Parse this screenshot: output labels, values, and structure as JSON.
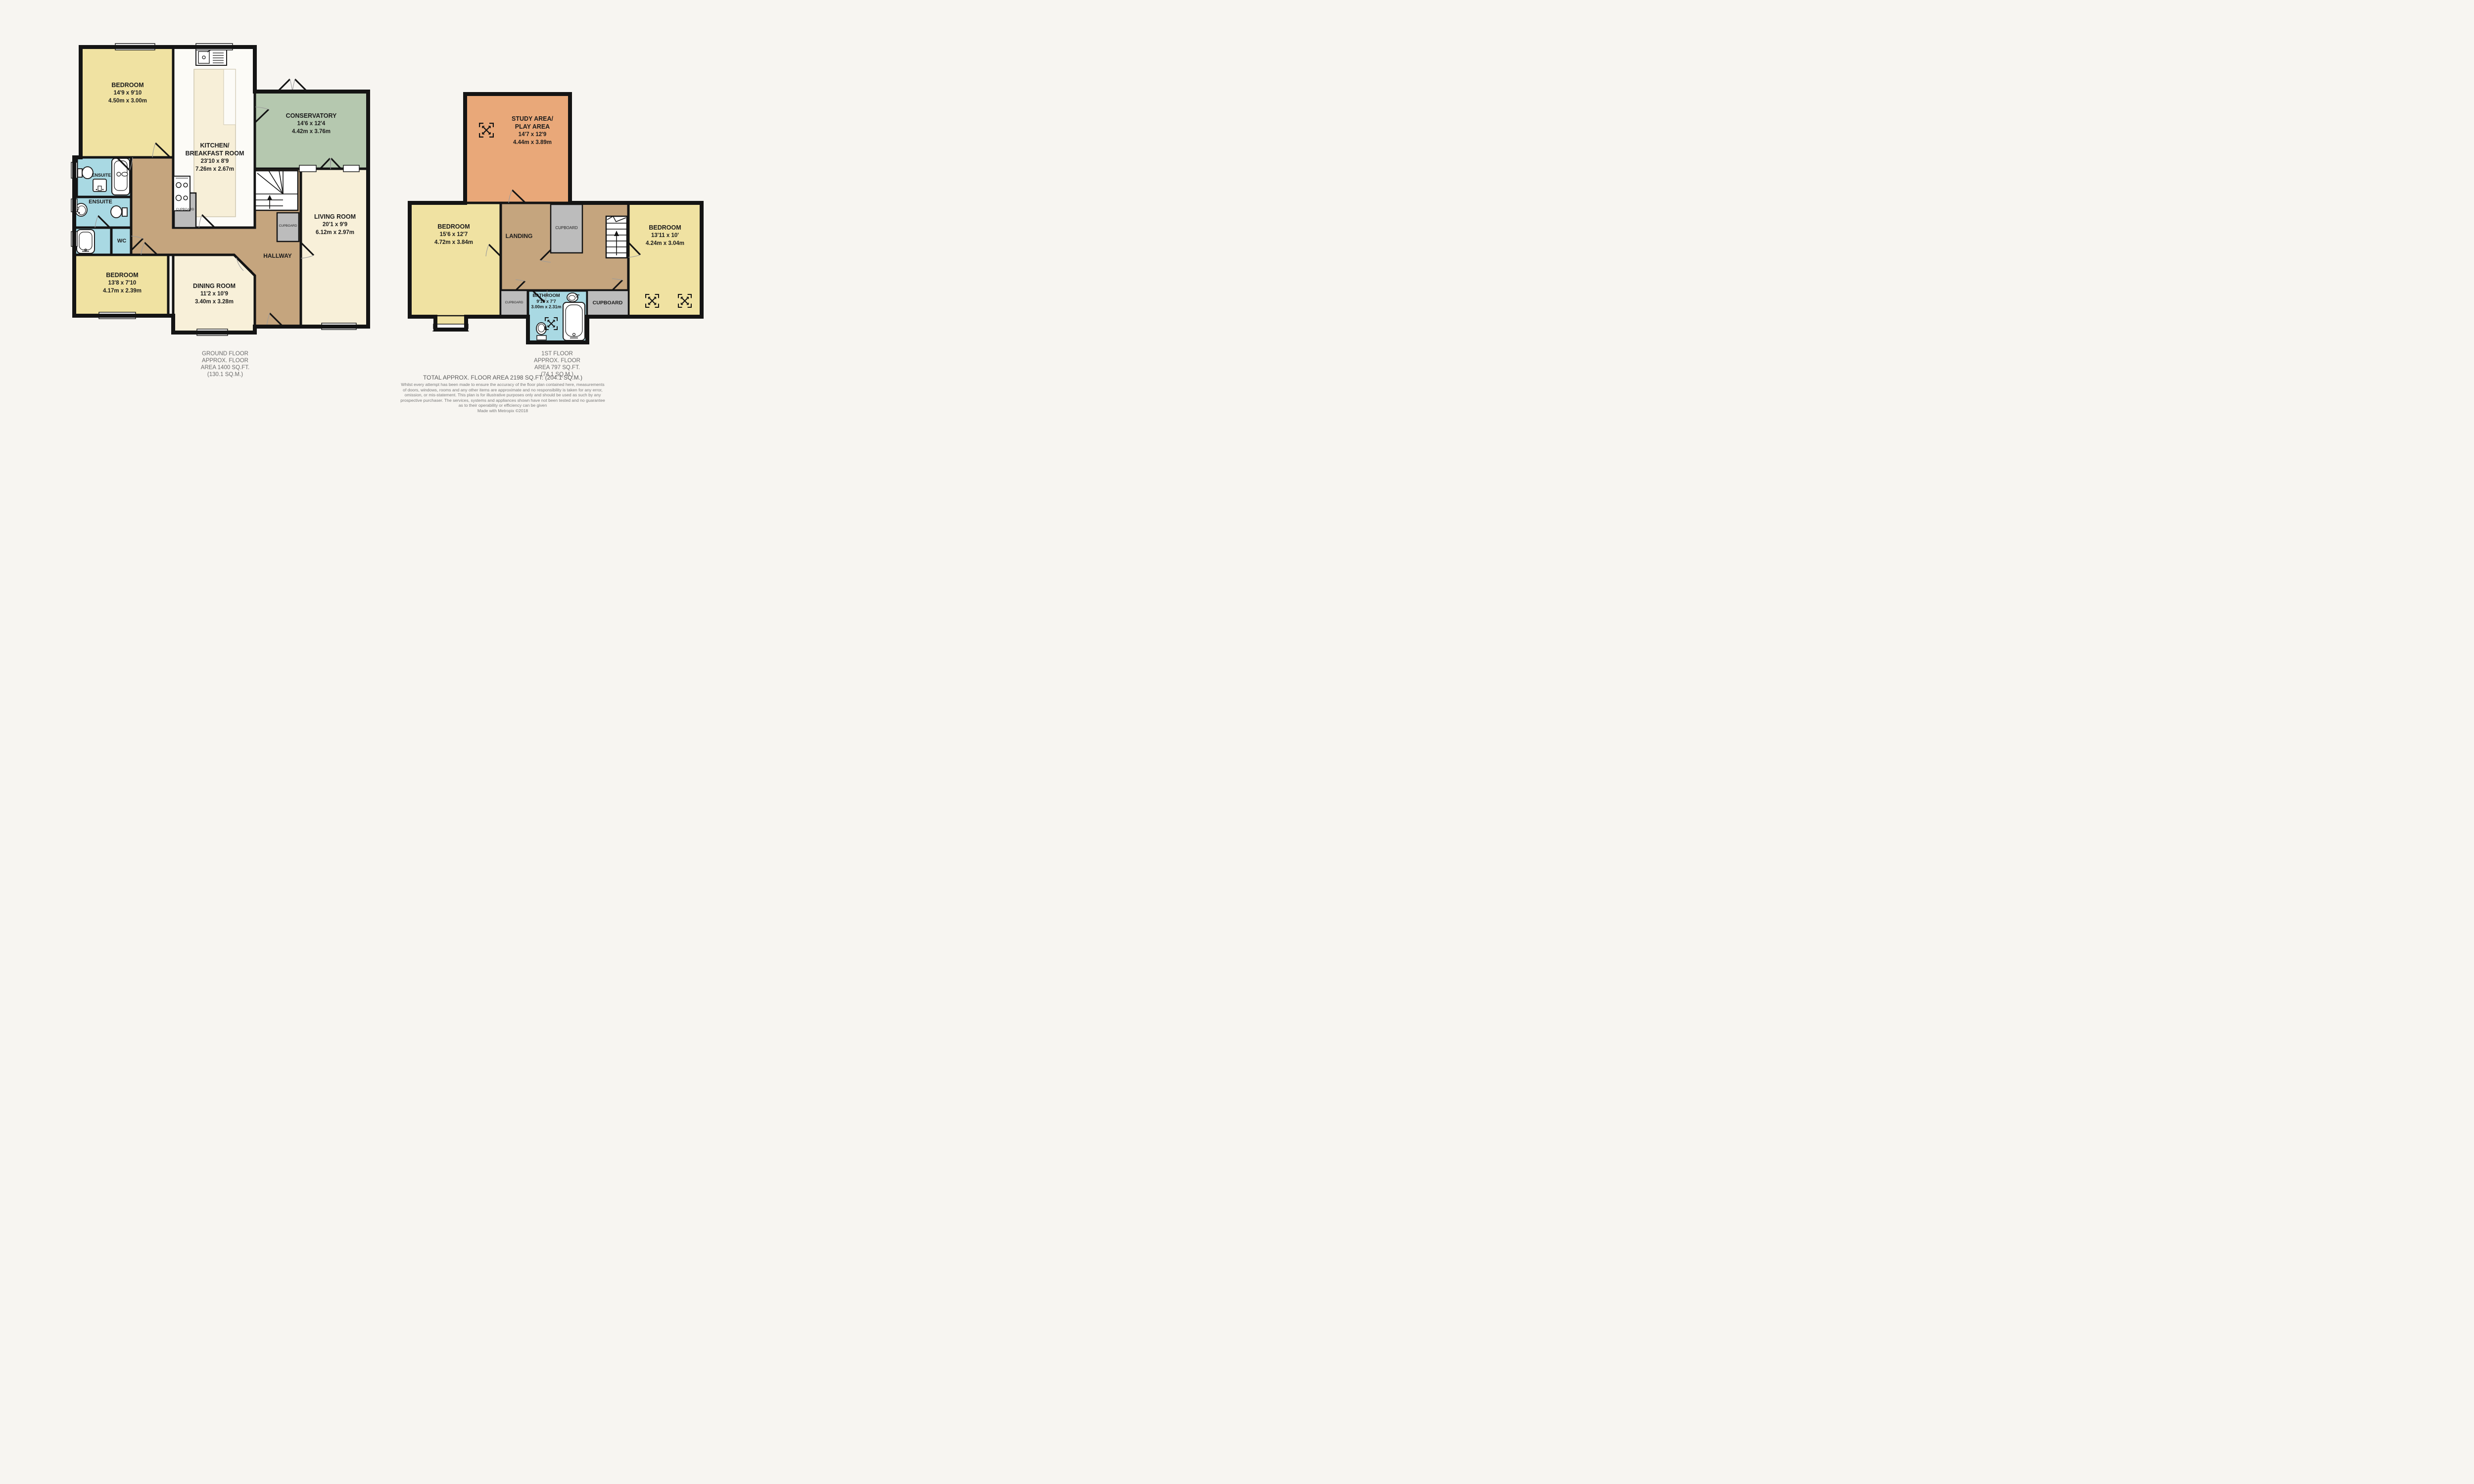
{
  "colors": {
    "background": "#f7f5f1",
    "wall": "#141414",
    "bedroom_yellow": "#f0e2a2",
    "cream": "#f8f0d9",
    "conservatory_green": "#b5c8af",
    "bathroom_blue": "#a9d9e3",
    "hallway_brown": "#c5a57e",
    "study_orange": "#e9a879",
    "cupboard_gray": "#bcbcbc",
    "kitchen_white": "#fcfbf7",
    "island_cream": "#f7efd8",
    "caption_text": "#6b6b6b"
  },
  "ground_floor": {
    "rooms": {
      "bedroom_top": {
        "name": "BEDROOM",
        "dims_ft": "14'9 x 9'10",
        "dims_m": "4.50m x 3.00m"
      },
      "kitchen": {
        "name_line1": "KITCHEN/",
        "name_line2": "BREAKFAST ROOM",
        "dims_ft": "23'10 x 8'9",
        "dims_m": "7.26m x 2.67m"
      },
      "conservatory": {
        "name": "CONSERVATORY",
        "dims_ft": "14'6 x 12'4",
        "dims_m": "4.42m x 3.76m"
      },
      "living_room": {
        "name": "LIVING ROOM",
        "dims_ft": "20'1 x 9'9",
        "dims_m": "6.12m x 2.97m"
      },
      "ensuite_top": {
        "name": "ENSUITE"
      },
      "ensuite_main": {
        "name": "ENSUITE"
      },
      "wc": {
        "name": "WC"
      },
      "bedroom_bottom": {
        "name": "BEDROOM",
        "dims_ft": "13'8 x 7'10",
        "dims_m": "4.17m x 2.39m"
      },
      "dining_room": {
        "name": "DINING ROOM",
        "dims_ft": "11'2 x 10'9",
        "dims_m": "3.40m x 3.28m"
      },
      "hallway": {
        "name": "HALLWAY"
      },
      "cupboard_kitchen": {
        "name": "CUPBOARD"
      },
      "cupboard_stairs": {
        "name": "CUPBOARD"
      }
    },
    "caption": [
      "GROUND FLOOR",
      "APPROX. FLOOR",
      "AREA 1400 SQ.FT.",
      "(130.1 SQ.M.)"
    ]
  },
  "first_floor": {
    "rooms": {
      "study_area": {
        "name_line1": "STUDY AREA/",
        "name_line2": "PLAY AREA",
        "dims_ft": "14'7 x 12'9",
        "dims_m": "4.44m x 3.89m"
      },
      "bedroom_left": {
        "name": "BEDROOM",
        "dims_ft": "15'6 x 12'7",
        "dims_m": "4.72m x 3.84m"
      },
      "landing": {
        "name": "LANDING"
      },
      "bedroom_right": {
        "name": "BEDROOM",
        "dims_ft": "13'11 x 10'",
        "dims_m": "4.24m x 3.04m"
      },
      "bathroom": {
        "name": "BATHROOM",
        "dims_ft": "9'10 x 7'7",
        "dims_m": "3.00m x 2.31m"
      },
      "cupboard_top": {
        "name": "CUPBOARD"
      },
      "cupboard_left": {
        "name": "CUPBOARD"
      },
      "cupboard_right": {
        "name": "CUPBOARD"
      }
    },
    "caption": [
      "1ST FLOOR",
      "APPROX. FLOOR",
      "AREA 797 SQ.FT.",
      "(74.1 SQ.M.)"
    ]
  },
  "footer": {
    "total_area": "TOTAL APPROX. FLOOR AREA 2198 SQ.FT. (204.1 SQ.M.)",
    "disclaimer": [
      "Whilst every attempt has been made to ensure the accuracy of the floor plan contained here, measurements",
      "of doors, windows, rooms and any other items are approximate and no responsibility is taken for any error,",
      "omission, or mis-statement. This plan is for illustrative purposes only and should be used as such by any",
      "prospective purchaser. The services, systems and appliances shown have not been tested and no guarantee",
      "as to their operability or efficiency can be given"
    ],
    "credit": "Made with Metropix ©2018"
  }
}
